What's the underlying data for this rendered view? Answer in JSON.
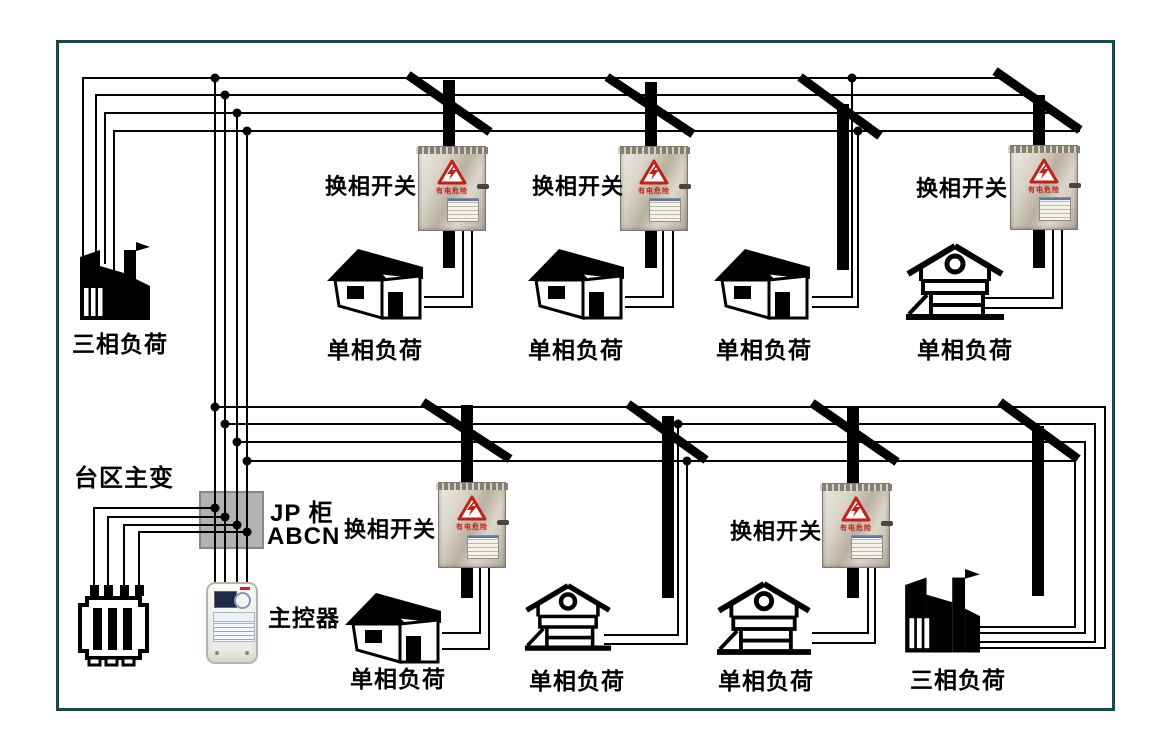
{
  "colors": {
    "frame": "#0d4e4e",
    "wire": "#000000",
    "warning_red": "#c22018",
    "jp_cabinet_fill": "#b2b2b2"
  },
  "station": {
    "transformer_label": "台区主变",
    "cabinet_label_line1": "JP 柜",
    "cabinet_label_line2": "ABCN",
    "controller_label": "主控器"
  },
  "switch_box": {
    "warning_text": "有电危险"
  },
  "top_row": {
    "switches": [
      {
        "label": "换相开关"
      },
      {
        "label": "换相开关"
      },
      {
        "label": "换相开关"
      }
    ],
    "loads": [
      {
        "type": "factory",
        "label": "三相负荷"
      },
      {
        "type": "house",
        "label": "单相负荷"
      },
      {
        "type": "house",
        "label": "单相负荷"
      },
      {
        "type": "house",
        "label": "单相负荷"
      },
      {
        "type": "villa",
        "label": "单相负荷"
      }
    ]
  },
  "bottom_row": {
    "switches": [
      {
        "label": "换相开关"
      },
      {
        "label": "换相开关"
      }
    ],
    "loads": [
      {
        "type": "house",
        "label": "单相负荷"
      },
      {
        "type": "villa",
        "label": "单相负荷"
      },
      {
        "type": "villa",
        "label": "单相负荷"
      },
      {
        "type": "factory",
        "label": "三相负荷"
      }
    ]
  }
}
